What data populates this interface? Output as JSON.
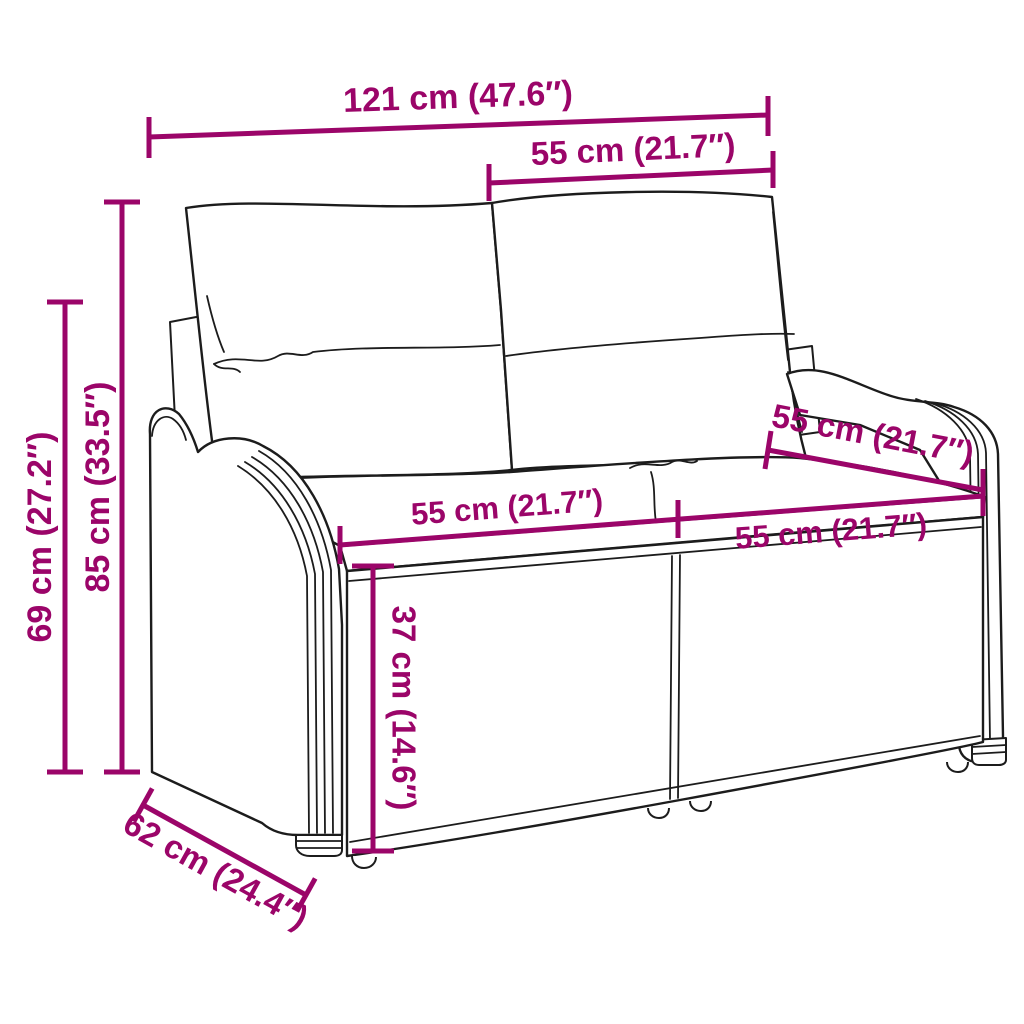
{
  "figure": {
    "description": "Line drawing of a two-seat poly rattan garden bench with two back cushions and two seat cushions, annotated with measurements",
    "style": "technical product dimension diagram"
  },
  "colors": {
    "accent": "#9b0569",
    "line": "#1c1c1c",
    "background": "#ffffff"
  },
  "dimensions": {
    "overall_width": "121 cm (47.6″)",
    "back_cushion_width": "55 cm (21.7″)",
    "total_height": "85 cm (33.5″)",
    "armrest_height": "69 cm (27.2″)",
    "seat_width_left": "55 cm (21.7″)",
    "seat_width_right": "55 cm (21.7″)",
    "armrest_depth": "55 cm (21.7″)",
    "seat_height": "37 cm (14.6″)",
    "overall_depth": "62 cm (24.4″)"
  }
}
